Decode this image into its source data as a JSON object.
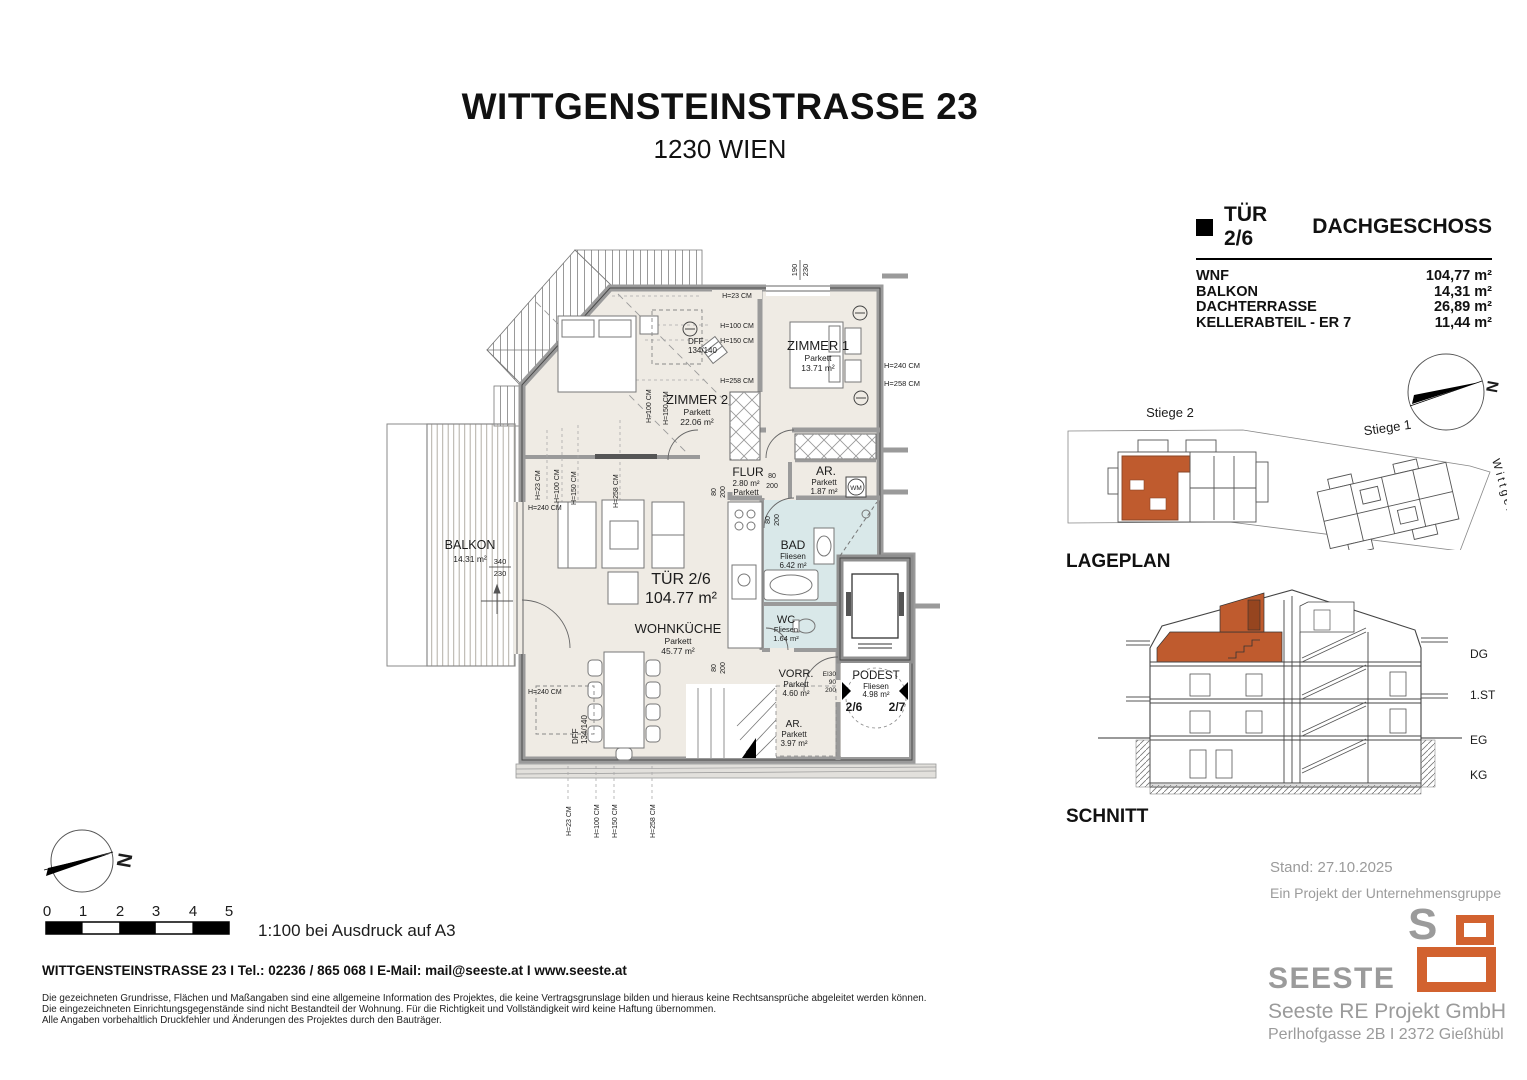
{
  "header": {
    "title": "WITTGENSTEINSTRASSE 23",
    "subtitle": "1230 WIEN"
  },
  "info_panel": {
    "unit": "TÜR 2/6",
    "floor_name": "DACHGESCHOSS",
    "rows": [
      {
        "label": "WNF",
        "value": "104,77 m²"
      },
      {
        "label": "BALKON",
        "value": "14,31 m²"
      },
      {
        "label": "DACHTERRASSE",
        "value": "26,89 m²"
      },
      {
        "label": "KELLERABTEIL - ER 7",
        "value": "11,44 m²"
      }
    ]
  },
  "plan": {
    "unit_name": "TÜR 2/6",
    "unit_area": "104.77 m²",
    "rooms": {
      "zimmer1": {
        "name": "ZIMMER 1",
        "floor": "Parkett",
        "area": "13.71 m²"
      },
      "zimmer2": {
        "name": "ZIMMER 2",
        "floor": "Parkett",
        "area": "22.06 m²"
      },
      "flur": {
        "name": "FLUR",
        "area": "2.80 m²",
        "floor": "Parkett"
      },
      "ar1": {
        "name": "AR.",
        "floor": "Parkett",
        "area": "1.87 m²"
      },
      "bad": {
        "name": "BAD",
        "floor": "Fliesen",
        "area": "6.42 m²"
      },
      "wc": {
        "name": "WC",
        "floor": "Fliesen",
        "area": "1.64 m²"
      },
      "wohnkueche": {
        "name": "WOHNKÜCHE",
        "floor": "Parkett",
        "area": "45.77 m²"
      },
      "vorr": {
        "name": "VORR.",
        "floor": "Parkett",
        "area": "4.60 m²"
      },
      "podest": {
        "name": "PODEST",
        "floor": "Fliesen",
        "area": "4.98 m²"
      },
      "ar2": {
        "name": "AR.",
        "floor": "Parkett",
        "area": "3.97 m²"
      },
      "balkon": {
        "name": "BALKON",
        "area": "14.31 m²"
      }
    },
    "labels": {
      "h23": "H=23 CM",
      "h100": "H=100 CM",
      "h150": "H=150 CM",
      "h240": "H=240 CM",
      "h258": "H=258 CM",
      "wm": "WM",
      "dff": "DFF",
      "dff_size": "134/140",
      "w190": "190",
      "w230": "230",
      "w340": "340",
      "d80": "80",
      "d200": "200",
      "d90": "90",
      "ei30": "EI30",
      "door_left": "2/6",
      "door_right": "2/7"
    }
  },
  "lageplan": {
    "title": "LAGEPLAN",
    "stiege2": "Stiege 2",
    "stiege1": "Stiege 1",
    "street": "Wittgensteinstr.",
    "north": "N"
  },
  "schnitt": {
    "title": "SCHNITT",
    "levels": {
      "dg": "DG",
      "st1": "1.ST",
      "eg": "EG",
      "kg": "KG"
    }
  },
  "scalebar": {
    "ticks": [
      "0",
      "1",
      "2",
      "3",
      "4",
      "5"
    ],
    "note": "1:100 bei Ausdruck auf A3",
    "north": "N"
  },
  "footer": {
    "contact": "WITTGENSTEINSTRASSE 23 I Tel.: 02236 / 865 068 I E-Mail: mail@seeste.at I www.seeste.at",
    "disclaimers": [
      "Die gezeichneten Grundrisse, Flächen und Maßangaben sind eine allgemeine Information des Projektes, die keine Vertragsgrunslage bilden und hieraus keine Rechtsansprüche abgeleitet werden können.",
      "Die eingezeichneten Einrichtungsgegenstände sind nicht Bestandteil der Wohnung. Für die Richtigkeit und Vollständigkeit wird keine Haftung übernommen.",
      "Alle Angaben vorbehaltlich Druckfehler und Änderungen des Projektes durch den Bauträger."
    ]
  },
  "branding": {
    "stand": "Stand: 27.10.2025",
    "group": "Ein Projekt der Unternehmensgruppe",
    "logo_s": "S",
    "logo_text": "SEESTE",
    "company": "Seeste RE Projekt GmbH",
    "address": "Perlhofgasse 2B I 2372 Gießhübl",
    "orange": "#d2622f",
    "gray": "#9b9b9b"
  },
  "colors": {
    "highlight": "#bf5b2e",
    "floor": "#efebe4",
    "bath": "#d9e8e9",
    "wall": "#9e9e9e"
  }
}
